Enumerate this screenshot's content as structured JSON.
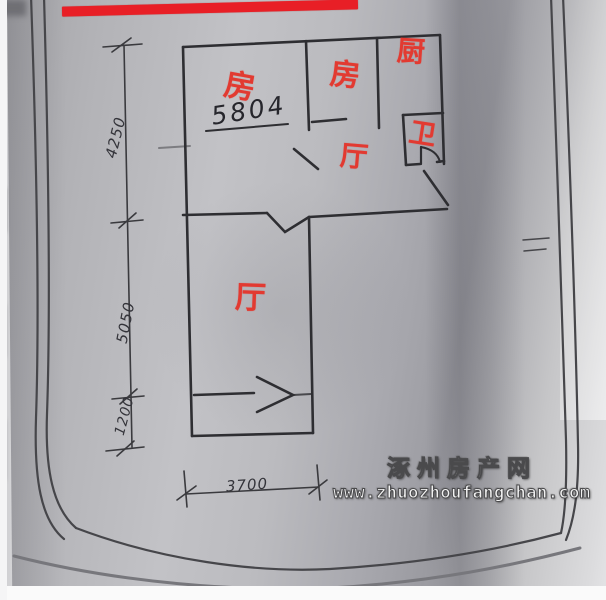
{
  "photo": {
    "type": "hand-drawn floor plan photographed on paper",
    "redaction_bar_color": "#e81f26",
    "paper_tone": "#b3b3b7",
    "ink_color": "#2e2e32",
    "room_label_color": "#e23a31"
  },
  "floor_plan": {
    "rooms": [
      {
        "name": "bedroom-1",
        "label": "房"
      },
      {
        "name": "bedroom-2",
        "label": "房"
      },
      {
        "name": "kitchen",
        "label": "厨"
      },
      {
        "name": "bathroom",
        "label": "卫"
      },
      {
        "name": "hall-upper",
        "label": "厅"
      },
      {
        "name": "hall-lower",
        "label": "厅"
      }
    ],
    "area_note": "5804",
    "dimensions": {
      "left_upper": "4250",
      "left_middle": "5050",
      "left_lower": "1200",
      "bottom": "3700"
    }
  },
  "watermark": {
    "site_name": "涿州房产网",
    "site_url": "www.zhuozhoufangchan.com",
    "fill_color": "#f2f2f2"
  }
}
